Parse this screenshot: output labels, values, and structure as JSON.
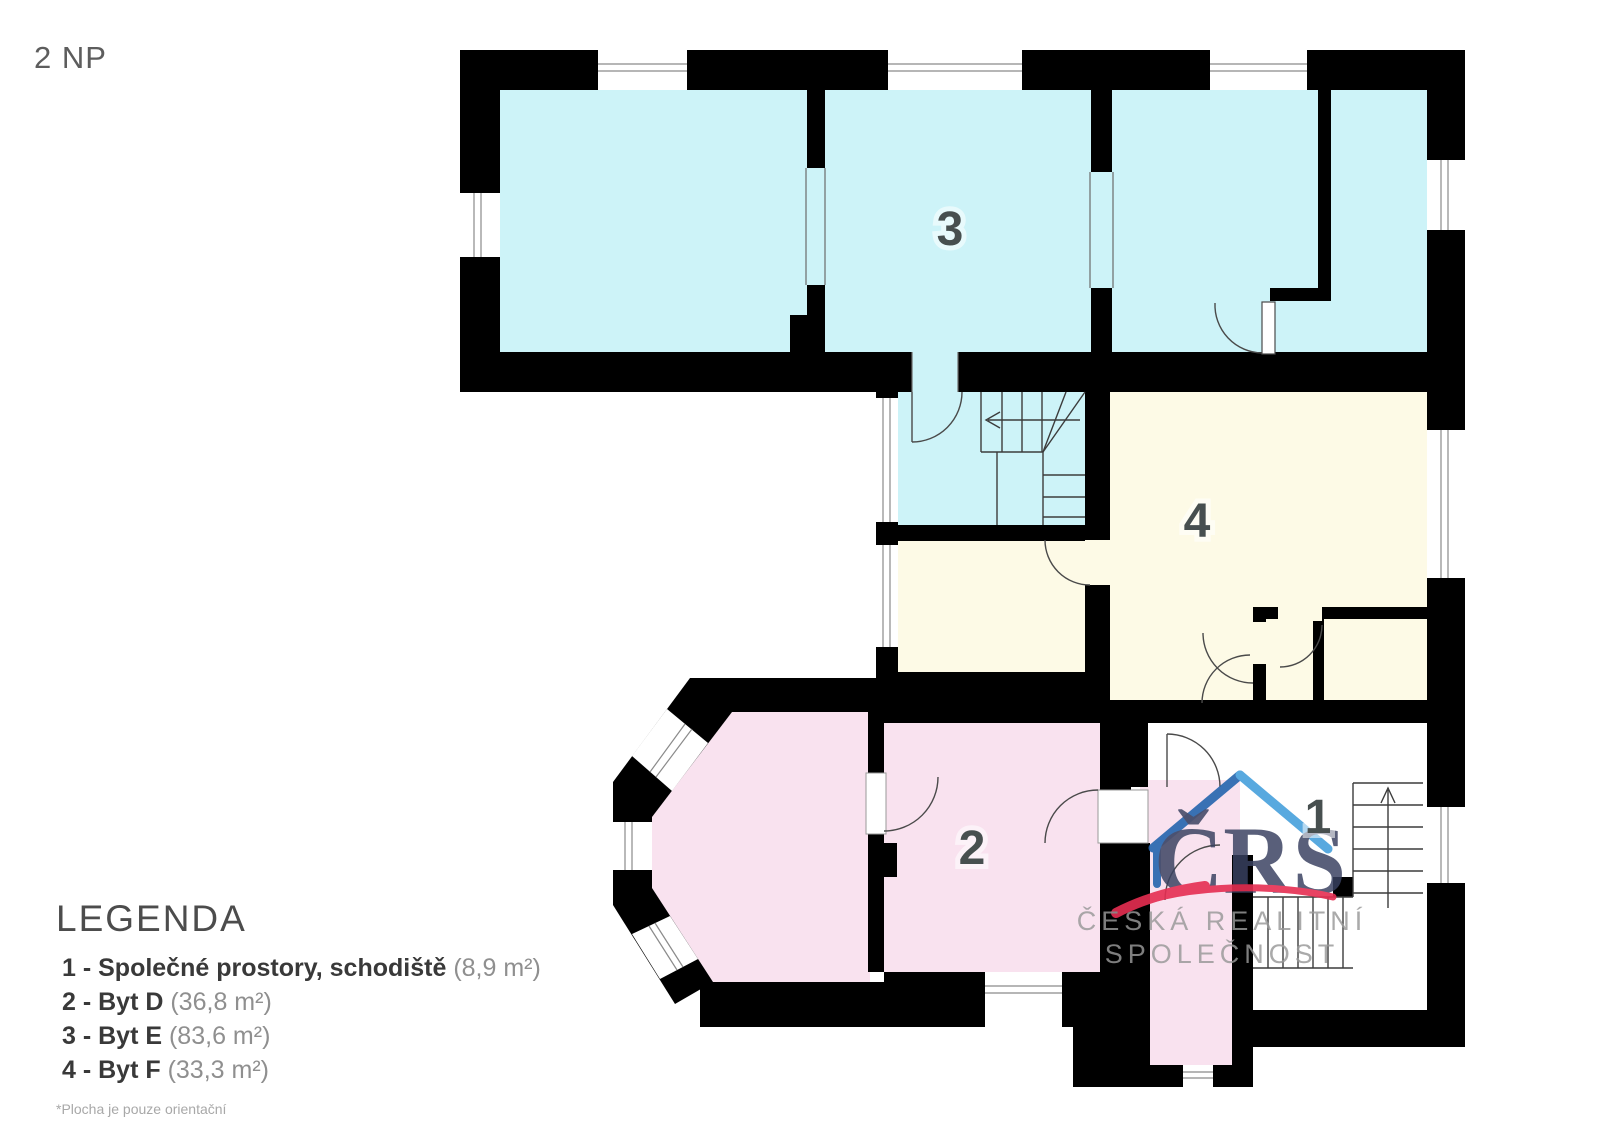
{
  "page": {
    "title": "2 NP"
  },
  "legend": {
    "heading": "LEGENDA",
    "items": [
      {
        "name": "1 - Společné prostory, schodiště",
        "area": "(8,9 m²)"
      },
      {
        "name": "2 - Byt D",
        "area": "(36,8 m²)"
      },
      {
        "name": "3 - Byt E",
        "area": "(83,6 m²)"
      },
      {
        "name": "4 - Byt F",
        "area": "(33,3 m²)"
      }
    ],
    "footnote": "*Plocha je pouze orientační"
  },
  "plan": {
    "room_labels": {
      "common": "1",
      "byt_d": "2",
      "byt_e": "3",
      "byt_f": "4"
    }
  },
  "logo": {
    "acronym": "ČRS",
    "name_line1": "ČESKÁ REALITNÍ",
    "name_line2": "SPOLEČNOST"
  },
  "colors": {
    "walls": "#000000",
    "apartment_common": "#ffffff",
    "apartment_d_pink": "#f9e2ef",
    "apartment_e_cyan": "#cdf3f8",
    "apartment_f_yellow": "#fdfae6",
    "logo_blue": "#2f6fb3",
    "logo_light_blue": "#47a0dc",
    "logo_navy": "#3a4160",
    "logo_red": "#e62e52"
  }
}
